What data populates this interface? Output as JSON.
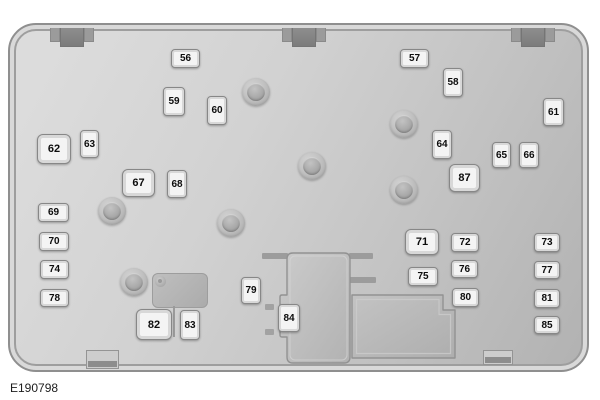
{
  "figure": {
    "code": "E190798"
  },
  "diagram_title": "",
  "colors": {
    "panel_face_light": "#dcdcdc",
    "panel_face_dark": "#b2b2b2",
    "panel_border": "#8f8f8f",
    "label_face": "#f4f4f4",
    "label_border": "#878787",
    "label_text": "#0d0d0d"
  },
  "fuses": {
    "f56": "56",
    "f57": "57",
    "f58": "58",
    "f59": "59",
    "f60": "60",
    "f61": "61",
    "f62": "62",
    "f63": "63",
    "f64": "64",
    "f65": "65",
    "f66": "66",
    "f67": "67",
    "f68": "68",
    "f69": "69",
    "f70": "70",
    "f71": "71",
    "f72": "72",
    "f73": "73",
    "f74": "74",
    "f75": "75",
    "f76": "76",
    "f77": "77",
    "f78": "78",
    "f79": "79",
    "f80": "80",
    "f81": "81",
    "f82": "82",
    "f83": "83",
    "f84": "84",
    "f85": "85",
    "f87": "87"
  }
}
